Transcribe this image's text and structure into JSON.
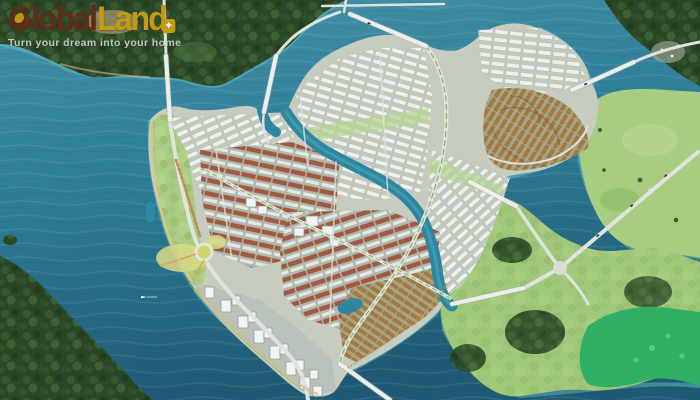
{
  "brand": {
    "name_part1": "Global",
    "name_part2": "Land",
    "tagline": "Turn your dream into your home",
    "star_icon": "✦"
  },
  "palette": {
    "brand_dark": "#5e2c18",
    "brand_gold": "#c49a10",
    "tagline_gray": "#d7deda",
    "water_deep": "#1f5a74",
    "water_mid": "#2f7e98",
    "water_light": "#4493a8",
    "shore_glow": "#73ccd4",
    "forest_dark": "#2b4727",
    "field_green": "#a4c97c",
    "emerald_field": "#2fb065",
    "urban_base": "#c6cdc0",
    "roof_red": "#a6573f",
    "roof_white": "#eef1ea",
    "villa_orange": "#aa7a42",
    "road_gray": "#dfe3dd",
    "sand": "#e0c08f"
  },
  "scene": {
    "type": "aerial-masterplan-render",
    "regions": [
      {
        "id": "north-forest",
        "label": "riverside forest (north bank)"
      },
      {
        "id": "northeast-forest",
        "label": "forest (northeast bank)"
      },
      {
        "id": "east-fields",
        "label": "green fields (east bank)"
      },
      {
        "id": "east-island",
        "label": "green island with road junction"
      },
      {
        "id": "emerald-field",
        "label": "bright emerald field"
      },
      {
        "id": "main-peninsula",
        "label": "township peninsula"
      },
      {
        "id": "west-coastal-park",
        "label": "coastal park strip"
      },
      {
        "id": "white-housing-districts",
        "label": "white-roof housing grids"
      },
      {
        "id": "red-roof-district",
        "label": "terracotta-roof blocks"
      },
      {
        "id": "villa-fan-district",
        "label": "fan-shaped villa quarter"
      },
      {
        "id": "southeast-villa-district",
        "label": "orange villa rows"
      },
      {
        "id": "waterfront-tower-district",
        "label": "waterfront towers"
      },
      {
        "id": "central-roundabout",
        "label": "roundabout park"
      },
      {
        "id": "inner-river",
        "label": "winding inner channel"
      },
      {
        "id": "bridges",
        "label": "river bridges"
      },
      {
        "id": "boat",
        "label": "small boat"
      }
    ]
  }
}
